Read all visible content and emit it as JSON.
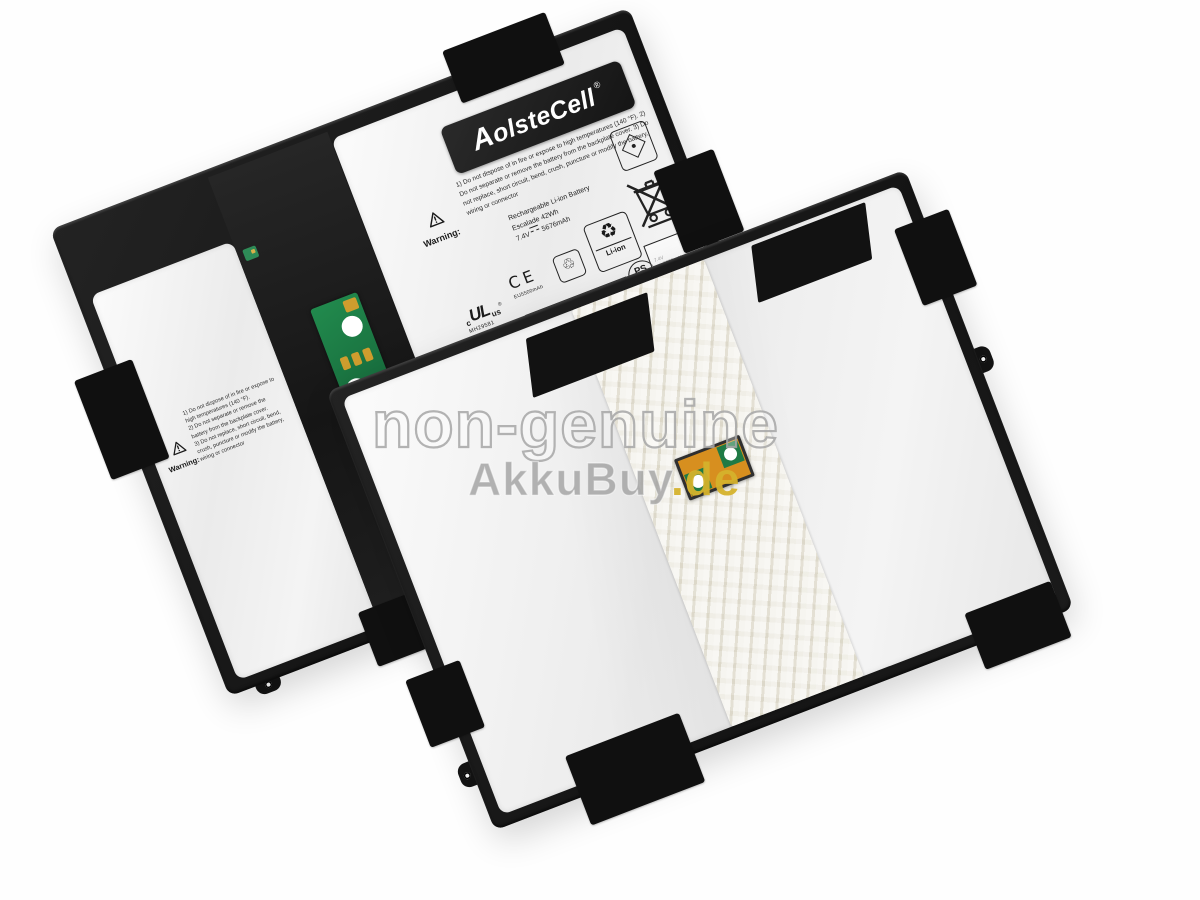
{
  "watermark": {
    "line1": "non-genuine",
    "brand": "AkkuBuy",
    "tld": ".de"
  },
  "front_battery": {
    "logo": {
      "text": "AolsteCell",
      "registered": "®"
    },
    "warning_title": "Warning:",
    "warning_lines": [
      "1) Do not dispose of in fire or expose to high temperatures (140 °F).",
      "2) Do not separate or remove the battery from the backplate cover.",
      "3) Do not replace, short circuit, bend, crush, puncture or modify the battery, wiring or connector"
    ],
    "specs": {
      "line1": "Rechargeable Li-ion Battery",
      "line2": "Escalade 42Wh",
      "voltage": "7.4V",
      "capacity": "5676mAh"
    },
    "marks": {
      "ce": "CE",
      "ce_note": "EU5500mAh",
      "ul_c": "c",
      "ul": "UL",
      "ul_us": "us",
      "ul_registered": "®",
      "ul_file": "MH29581",
      "pse_ps": "PS",
      "pse_e": "E",
      "pse_note1": "7.4V",
      "pse_note2": "min5300mAh",
      "li_ion": "Li-ion"
    }
  },
  "icons": {
    "recycle": "♻",
    "mobius": "♲"
  },
  "colors": {
    "frame": "#161616",
    "pouch_surface": "#f3f3f3",
    "center_strip": "#1e1e1e",
    "pcb_green": "#1f7a45",
    "pad_gold": "#cf9d2e",
    "tape": "#ece9dd",
    "window_orange": "#d78f1f",
    "watermark_outline": "#a6a6a6",
    "akkubuy_gray": "#a2a2a2",
    "akkubuy_gold": "#d5b22c"
  }
}
